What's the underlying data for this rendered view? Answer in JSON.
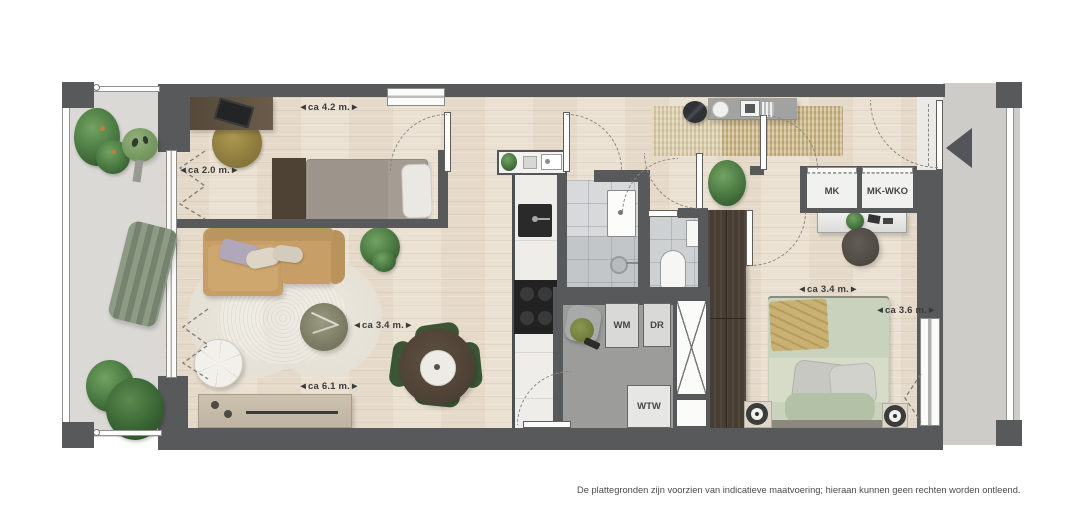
{
  "labels": {
    "mk": "MK",
    "mk_wko": "MK-WKO",
    "wm": "WM",
    "dr": "DR",
    "wtw": "WTW"
  },
  "dimensions": {
    "study_width": "◄ca 4.2 m.►",
    "study_depth": "◄ca 2.0 m.►",
    "living_width": "◄ca 6.1 m.►",
    "living_depth": "◄ca 3.4 m.►",
    "bedroom_width": "◄ca 3.4 m.►",
    "bedroom_depth": "◄ca 3.6 m.►"
  },
  "footer": {
    "disclaimer": "De plattegronden zijn voorzien van indicatieve maatvoering; hieraan kunnen geen rechten worden ontleend."
  },
  "colors": {
    "wall": "#58595b",
    "wood_floor": "#e9dfd0",
    "balcony_floor": "#dad9d5",
    "gallery_floor": "#cdccc8",
    "tile_light": "#d7d9da",
    "tile_dark": "#c3c6c8",
    "storage_floor": "#9c9c9a",
    "sofa": "#c79f66",
    "bed_green": "#c9d2bd",
    "plant_green": "#4c7c43",
    "dimension_text": "#3a3a3a"
  }
}
